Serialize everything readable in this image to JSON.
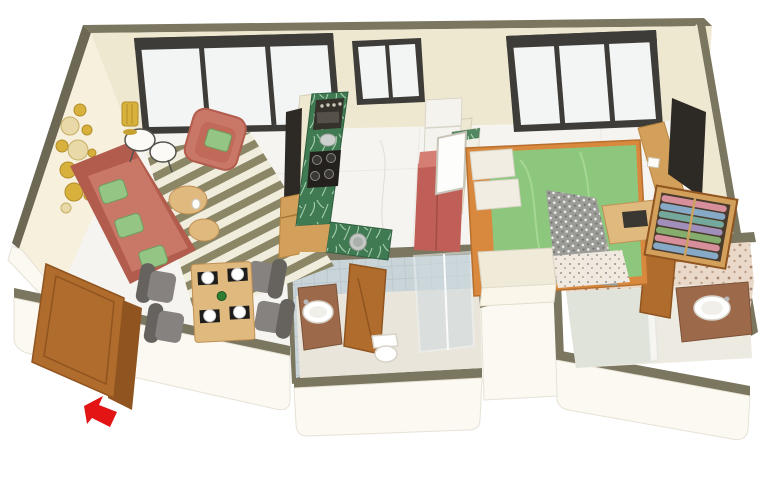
{
  "scene": {
    "type": "3d-isometric-floor-plan-render",
    "description": "3D rendered isometric floor plan of a one-bedroom apartment on a white background. Open living/dining room with kitchen on the left half, bedroom on the right, two bathrooms along the bottom, and an open wooden entrance door at the lower left marked with a red arrow.",
    "background": "#ffffff",
    "visible_text": ""
  },
  "palette": {
    "wallTop": "#7b765f",
    "wallTopDark": "#6d6854",
    "wallFace": "#efe8d1",
    "wallFaceLight": "#f6f0dd",
    "wallWhite": "#fbf9f1",
    "edgeSoft": "#e6e2d6",
    "floor": "#f6f4f0",
    "floorVein": "#d9d4ce",
    "windowFrame": "#3d3c38",
    "glass": "#f3f4f4",
    "sofaCoral": "#c97767",
    "sofaCoralDark": "#b25c4d",
    "cushionGreen": "#94c584",
    "woodDoor": "#b06c2c",
    "woodDoorDark": "#8f5420",
    "woodTan": "#d3a05c",
    "woodLight": "#e0b97e",
    "counterGreen": "#3f7a52",
    "applianceDark": "#35322c",
    "fridgeRed": "#c05f57",
    "bedGreen": "#8dc77d",
    "bedFrameOrange": "#d8893e",
    "throwGray": "#9b9b97",
    "chairGray": "#83807d",
    "rugOlive": "#8b8766",
    "rugCream": "#f1eddd",
    "gold": "#d8b13c",
    "tileBlue": "#c9d4d9",
    "mosaicBase": "#ead9c9",
    "mosaicDot": "#a8886f",
    "marbleBrown": "#9c6a4b",
    "porcelain": "#ffffff",
    "arrowRed": "#e21414",
    "tvDark": "#2d2925",
    "clothesPink": "#d78f9b",
    "clothesBlue": "#86a9c7",
    "clothesGreen": "#84ad6e",
    "clothesPurple": "#9f8fba",
    "clothesTeal": "#74a89c"
  },
  "rooms": {
    "living": {
      "label": "Living room",
      "items": [
        "coral fabric sofa with green cushions",
        "coral armchair with green cushion",
        "two round black-leg side tables",
        "pleated gold floor lamp",
        "gold circular wall decor discs",
        "olive striped rug",
        "wooden nesting coffee tables",
        "TV with wooden cabinet on partition wall"
      ]
    },
    "dining": {
      "label": "Dining area",
      "items": [
        "light wooden four-seat table",
        "four grey upholstered chairs",
        "black placemats with white plates",
        "green bottle"
      ]
    },
    "kitchen": {
      "label": "Kitchen",
      "items": [
        "green marble counter run",
        "built-in grill appliance",
        "four-burner gas hob",
        "steel sink pot",
        "white refrigerator cabinet",
        "small marble-top table",
        "red cabinet"
      ]
    },
    "bedroom": {
      "label": "Bedroom",
      "items": [
        "double bed with orange wood frame and green bedding",
        "two white pillows",
        "grey knit throw",
        "dressing mirror",
        "desk with laptop",
        "patterned rug",
        "wooden wall console",
        "wall-mounted TV",
        "open wardrobe with rolled colorful clothes",
        "cream wardrobe cabinet"
      ]
    },
    "bathroom1": {
      "label": "Bathroom 1",
      "items": [
        "blue tiled walls",
        "brown marble washbasin counter",
        "white oval basin",
        "toilet",
        "glass shower enclosure",
        "open wooden door"
      ]
    },
    "bathroom2": {
      "label": "Bathroom 2",
      "items": [
        "beige mosaic tiled walls",
        "shower area with glass divider",
        "brown marble washbasin counter",
        "white oval basin",
        "open wooden door"
      ]
    },
    "entrance": {
      "label": "Entrance",
      "items": [
        "open wooden double door",
        "red arrow marking the entry point"
      ]
    }
  },
  "windows": {
    "living": "large three-pane window, dark frame",
    "kitchen": "two-pane window, dark frame",
    "bedroom": "three-pane window, dark frame"
  },
  "annotations": {
    "entrance_arrow": {
      "color": "#e21414",
      "meaning": "points to apartment entrance door"
    }
  }
}
